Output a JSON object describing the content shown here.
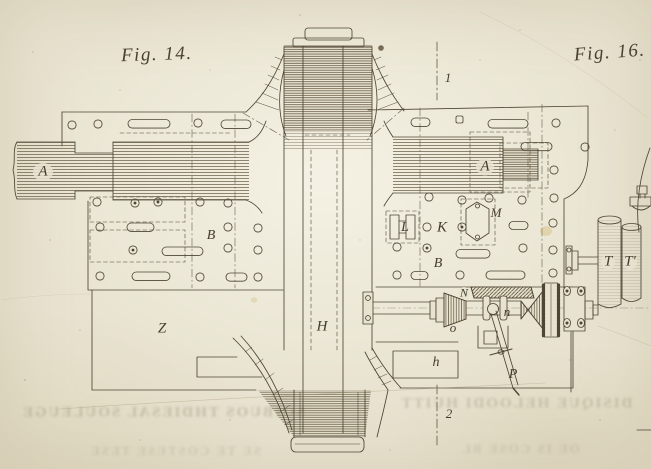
{
  "page": {
    "type": "scanned engraving plate",
    "paper_color": "#e8e3d0",
    "ink_color": "#4e4534"
  },
  "figures": {
    "fig14": {
      "label": "Fig. 14."
    },
    "fig16": {
      "label": "Fig. 16."
    }
  },
  "part_labels": [
    {
      "id": "shaft-a-left",
      "text": "A",
      "x": 43,
      "y": 172,
      "size": 15
    },
    {
      "id": "shaft-a-right",
      "text": "A",
      "x": 485,
      "y": 167,
      "size": 15
    },
    {
      "id": "plate-b-left",
      "text": "B",
      "x": 211,
      "y": 236,
      "size": 14
    },
    {
      "id": "plate-b-right",
      "text": "B",
      "x": 438,
      "y": 264,
      "size": 14
    },
    {
      "id": "part-l",
      "text": "L",
      "x": 405,
      "y": 228,
      "size": 14
    },
    {
      "id": "part-k",
      "text": "K",
      "x": 442,
      "y": 228,
      "size": 15
    },
    {
      "id": "part-m",
      "text": "M",
      "x": 496,
      "y": 213,
      "size": 13
    },
    {
      "id": "base-z",
      "text": "Z",
      "x": 162,
      "y": 329,
      "size": 15
    },
    {
      "id": "drum-h",
      "text": "H",
      "x": 322,
      "y": 327,
      "size": 15
    },
    {
      "id": "block-h",
      "text": "h",
      "x": 436,
      "y": 363,
      "size": 14
    },
    {
      "id": "gear-n-upper",
      "text": "N",
      "x": 464,
      "y": 293,
      "size": 12
    },
    {
      "id": "gear-o",
      "text": "o",
      "x": 453,
      "y": 328,
      "size": 13
    },
    {
      "id": "collar-n",
      "text": "n",
      "x": 507,
      "y": 312,
      "size": 13
    },
    {
      "id": "lever-p",
      "text": "P",
      "x": 513,
      "y": 375,
      "size": 14
    },
    {
      "id": "roller-t",
      "text": "T",
      "x": 608,
      "y": 262,
      "size": 15
    },
    {
      "id": "roller-t-prime",
      "text": "T'",
      "x": 630,
      "y": 262,
      "size": 15
    },
    {
      "id": "section-1",
      "text": "1",
      "x": 448,
      "y": 78,
      "size": 13
    },
    {
      "id": "section-2",
      "text": "2",
      "x": 449,
      "y": 414,
      "size": 13
    }
  ],
  "showthrough": {
    "lines": [
      {
        "text": "SOIBUOS THDIESAL SOULEUGE",
        "x": 163,
        "y": 413,
        "size": 15,
        "opacity": 0.35
      },
      {
        "text": "DISIQUE HELOODI HUITT",
        "x": 516,
        "y": 404,
        "size": 15,
        "opacity": 0.32
      },
      {
        "text": "SE TE COSTESE TESE",
        "x": 175,
        "y": 451,
        "size": 13,
        "opacity": 0.2
      },
      {
        "text": "OE IS COSE BL",
        "x": 520,
        "y": 449,
        "size": 13,
        "opacity": 0.2
      }
    ]
  }
}
